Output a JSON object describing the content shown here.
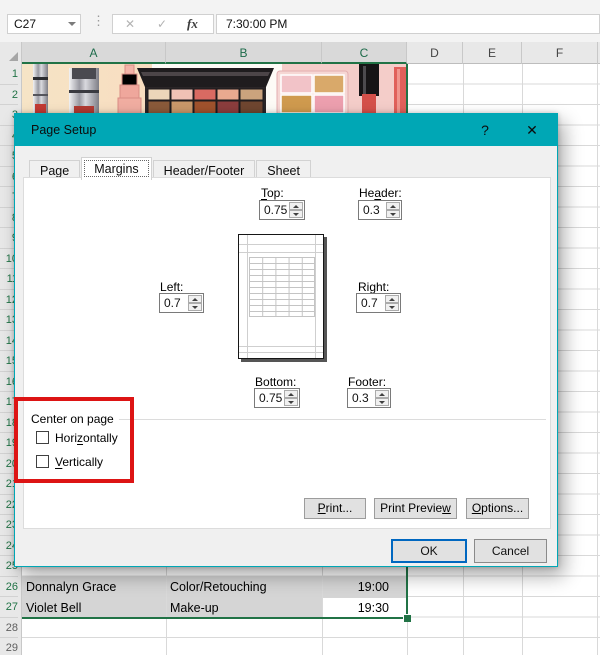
{
  "formula_bar": {
    "name_box": "C27",
    "handle_icon": "⋮",
    "cancel_icon": "✕",
    "enter_icon": "✓",
    "fx_icon": "fx",
    "value": "7:30:00 PM"
  },
  "sheet": {
    "columns": [
      {
        "label": "A",
        "selected": true
      },
      {
        "label": "B",
        "selected": true
      },
      {
        "label": "C",
        "selected": true
      },
      {
        "label": "D",
        "selected": false
      },
      {
        "label": "E",
        "selected": false
      },
      {
        "label": "F",
        "selected": false
      }
    ],
    "row_numbers": [
      "1",
      "2",
      "3",
      "4",
      "5",
      "6",
      "7",
      "8",
      "9",
      "10",
      "11",
      "12",
      "13",
      "14",
      "15",
      "16",
      "17",
      "18",
      "19",
      "20",
      "21",
      "22",
      "23",
      "24",
      "25",
      "26",
      "27",
      "28",
      "29"
    ],
    "selected_rows_through": 27,
    "cells": {
      "a26": "Donnalyn Grace",
      "b26": "Color/Retouching",
      "c26": "19:00",
      "a27": "Violet Bell",
      "b27": "Make-up",
      "c27": "19:30"
    }
  },
  "dialog": {
    "title": "Page Setup",
    "help_icon": "?",
    "close_icon": "✕",
    "tabs": [
      {
        "label": "Page",
        "selected": false
      },
      {
        "label": "Margins",
        "selected": true
      },
      {
        "label": "Header/Footer",
        "selected": false
      },
      {
        "label": "Sheet",
        "selected": false
      }
    ],
    "fields": {
      "top": {
        "pre": "",
        "key": "T",
        "post": "op:",
        "value": "0.75"
      },
      "header": {
        "pre": "He",
        "key": "a",
        "post": "der:",
        "value": "0.3"
      },
      "left": {
        "pre": "",
        "key": "L",
        "post": "eft:",
        "value": "0.7"
      },
      "right": {
        "pre": "",
        "key": "R",
        "post": "ight:",
        "value": "0.7"
      },
      "bottom": {
        "pre": "",
        "key": "B",
        "post": "ottom:",
        "value": "0.75"
      },
      "footer": {
        "pre": "",
        "key": "F",
        "post": "ooter:",
        "value": "0.3"
      }
    },
    "center_group": {
      "label": "Center on page",
      "horizontal": {
        "pre": "Hori",
        "key": "z",
        "post": "ontally",
        "checked": false
      },
      "vertical": {
        "pre": "",
        "key": "V",
        "post": "ertically",
        "checked": false
      }
    },
    "buttons": {
      "print": {
        "pre": "",
        "key": "P",
        "post": "rint..."
      },
      "print_preview": {
        "pre": "Print Previe",
        "key": "w",
        "post": ""
      },
      "options": {
        "pre": "",
        "key": "O",
        "post": "ptions..."
      },
      "ok": "OK",
      "cancel": "Cancel"
    }
  },
  "colors": {
    "titlebar_teal": "#00A7B5",
    "excel_green": "#217346",
    "annotation_red": "#DD1414",
    "selection_gray": "#D5D5D5",
    "ok_border_blue": "#0067C0"
  },
  "annotation": {
    "type": "highlight-rectangle"
  }
}
